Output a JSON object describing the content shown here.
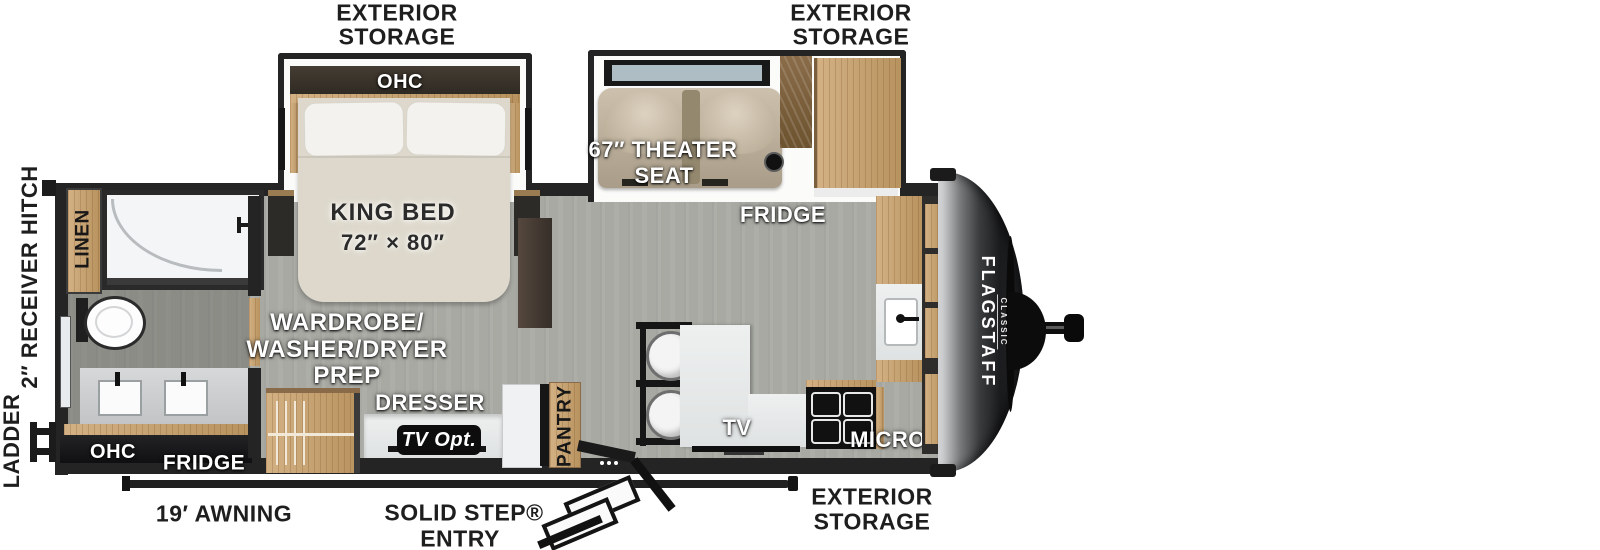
{
  "palette": {
    "wall": "#242424",
    "floor": "#a8a9a3",
    "wood": "#c8a97c",
    "counter": "#e9ebeb",
    "bed": "#ddd8cb",
    "theater_seat": "#c5b8a4",
    "front_cap": "#26282a",
    "label_dark": "#1e1e1e"
  },
  "exterior": {
    "storage_top_left": {
      "line1": "EXTERIOR",
      "line2": "STORAGE"
    },
    "storage_top_right": {
      "line1": "EXTERIOR",
      "line2": "STORAGE"
    },
    "storage_bottom_right": {
      "line1": "EXTERIOR",
      "line2": "STORAGE"
    },
    "receiver_hitch": "2″ RECEIVER HITCH",
    "ladder": "LADDER",
    "awning": "19′ AWNING",
    "solid_step": {
      "line1": "SOLID STEP®",
      "line2": "ENTRY"
    }
  },
  "bedroom": {
    "ohc": "OHC",
    "king_bed": {
      "line1": "KING BED",
      "line2": "72″ × 80″"
    }
  },
  "living": {
    "theater_seat": {
      "line1": "67″ THEATER",
      "line2": "SEAT"
    },
    "fridge": "FRIDGE"
  },
  "bath": {
    "linen": "LINEN",
    "ohc": "OHC",
    "fridge": "FRIDGE"
  },
  "mid": {
    "wardrobe": {
      "line1": "WARDROBE/",
      "line2": "WASHER/DRYER",
      "line3": "PREP"
    },
    "dresser": "DRESSER",
    "tv_opt": "TV Opt.",
    "pantry": "PANTRY"
  },
  "kitchen": {
    "tv": "TV",
    "micro": "MICRO",
    "ohc": "OHC"
  },
  "brand": {
    "name": "FLAGSTAFF",
    "series": "CLASSIC"
  }
}
